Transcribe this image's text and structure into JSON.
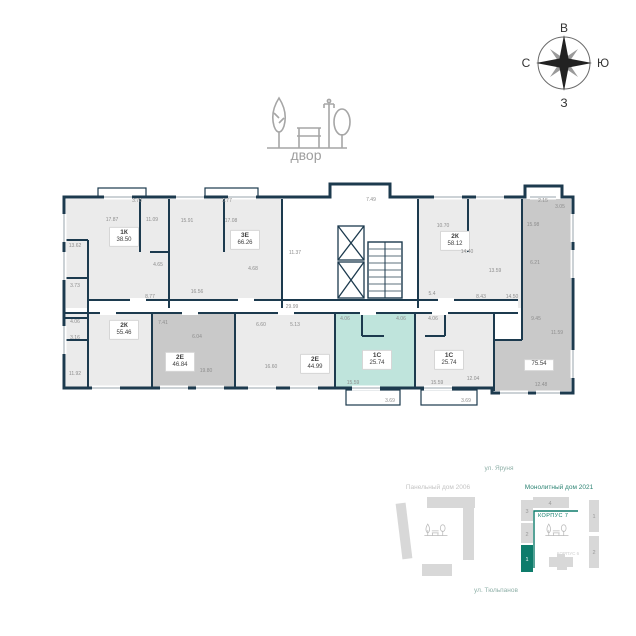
{
  "compass": {
    "top": "В",
    "right": "Ю",
    "bottom": "З",
    "left": "С"
  },
  "courtyard": {
    "label": "двор"
  },
  "floor_plan": {
    "apartments": [
      {
        "type": "1К",
        "area": "38.50",
        "status": "available"
      },
      {
        "type": "3Е",
        "area": "66.26",
        "status": "available"
      },
      {
        "type": "2К",
        "area": "58.12",
        "status": "available"
      },
      {
        "type": "",
        "area": "75.54",
        "status": "sold"
      },
      {
        "type": "2К",
        "area": "55.46",
        "status": "available"
      },
      {
        "type": "2Е",
        "area": "46.84",
        "status": "sold"
      },
      {
        "type": "2Е",
        "area": "44.99",
        "status": "available"
      },
      {
        "type": "1С",
        "area": "25.74",
        "status": "selected"
      },
      {
        "type": "1С",
        "area": "25.74",
        "status": "available"
      }
    ],
    "room_labels": [
      {
        "x": 137,
        "y": 201,
        "t": "3.78"
      },
      {
        "x": 227,
        "y": 201,
        "t": "3.77"
      },
      {
        "x": 371,
        "y": 200,
        "t": "7.49"
      },
      {
        "x": 543,
        "y": 201,
        "t": "2.15"
      },
      {
        "x": 112,
        "y": 220,
        "t": "17.87"
      },
      {
        "x": 152,
        "y": 220,
        "t": "11.09"
      },
      {
        "x": 158,
        "y": 265,
        "t": "4.65"
      },
      {
        "x": 150,
        "y": 297,
        "t": "8.77"
      },
      {
        "x": 75,
        "y": 246,
        "t": "13.62"
      },
      {
        "x": 75,
        "y": 286,
        "t": "3.73"
      },
      {
        "x": 75,
        "y": 322,
        "t": "4.06"
      },
      {
        "x": 75,
        "y": 338,
        "t": "3.16"
      },
      {
        "x": 75,
        "y": 374,
        "t": "11.92"
      },
      {
        "x": 187,
        "y": 221,
        "t": "15.91"
      },
      {
        "x": 231,
        "y": 221,
        "t": "17.08"
      },
      {
        "x": 197,
        "y": 292,
        "t": "16.56"
      },
      {
        "x": 253,
        "y": 269,
        "t": "4.68"
      },
      {
        "x": 295,
        "y": 253,
        "t": "11.37"
      },
      {
        "x": 292,
        "y": 307,
        "t": "29.99"
      },
      {
        "x": 443,
        "y": 226,
        "t": "10.70"
      },
      {
        "x": 467,
        "y": 252,
        "t": "14.40"
      },
      {
        "x": 495,
        "y": 271,
        "t": "13.59"
      },
      {
        "x": 481,
        "y": 297,
        "t": "8.43"
      },
      {
        "x": 432,
        "y": 294,
        "t": "5.4"
      },
      {
        "x": 512,
        "y": 297,
        "t": "14.50"
      },
      {
        "x": 533,
        "y": 225,
        "t": "15.98"
      },
      {
        "x": 560,
        "y": 207,
        "t": "3.05"
      },
      {
        "x": 535,
        "y": 263,
        "t": "6.21"
      },
      {
        "x": 536,
        "y": 319,
        "t": "9.45"
      },
      {
        "x": 557,
        "y": 333,
        "t": "11.59"
      },
      {
        "x": 541,
        "y": 385,
        "t": "12.48"
      },
      {
        "x": 163,
        "y": 323,
        "t": "7.41"
      },
      {
        "x": 197,
        "y": 337,
        "t": "6.04"
      },
      {
        "x": 206,
        "y": 371,
        "t": "19.80"
      },
      {
        "x": 261,
        "y": 325,
        "t": "6.60"
      },
      {
        "x": 295,
        "y": 325,
        "t": "5.13"
      },
      {
        "x": 271,
        "y": 367,
        "t": "16.60"
      },
      {
        "x": 345,
        "y": 319,
        "t": "4.06"
      },
      {
        "x": 401,
        "y": 319,
        "t": "4.06"
      },
      {
        "x": 353,
        "y": 383,
        "t": "15.59"
      },
      {
        "x": 390,
        "y": 401,
        "t": "3.69"
      },
      {
        "x": 433,
        "y": 319,
        "t": "4.06"
      },
      {
        "x": 437,
        "y": 383,
        "t": "15.59"
      },
      {
        "x": 473,
        "y": 379,
        "t": "12.04"
      },
      {
        "x": 466,
        "y": 401,
        "t": "3.69"
      }
    ]
  },
  "site_plan": {
    "street_top": "ул. Яруня",
    "street_bottom": "ул. Тюльпанов",
    "left_cluster_label": "Панельный дом 2006",
    "right_cluster_label": "Монолитный дом 2021",
    "current_korpus": "КОРПУС 7",
    "other_korpus": "КОРПУС 6",
    "buildings": {
      "strip_3": "3",
      "strip_2": "2",
      "strip_1": "1",
      "top_4": "4",
      "right_1": "1",
      "right_2": "2"
    }
  },
  "colors": {
    "accent_teal": "#0e7c6b",
    "selected_fill": "#bfe4dc",
    "wall_navy": "#1c3a4e",
    "sold_fill": "#c9c9c9",
    "available_fill": "#ebebeb",
    "label_gray": "#9e9e9e"
  }
}
